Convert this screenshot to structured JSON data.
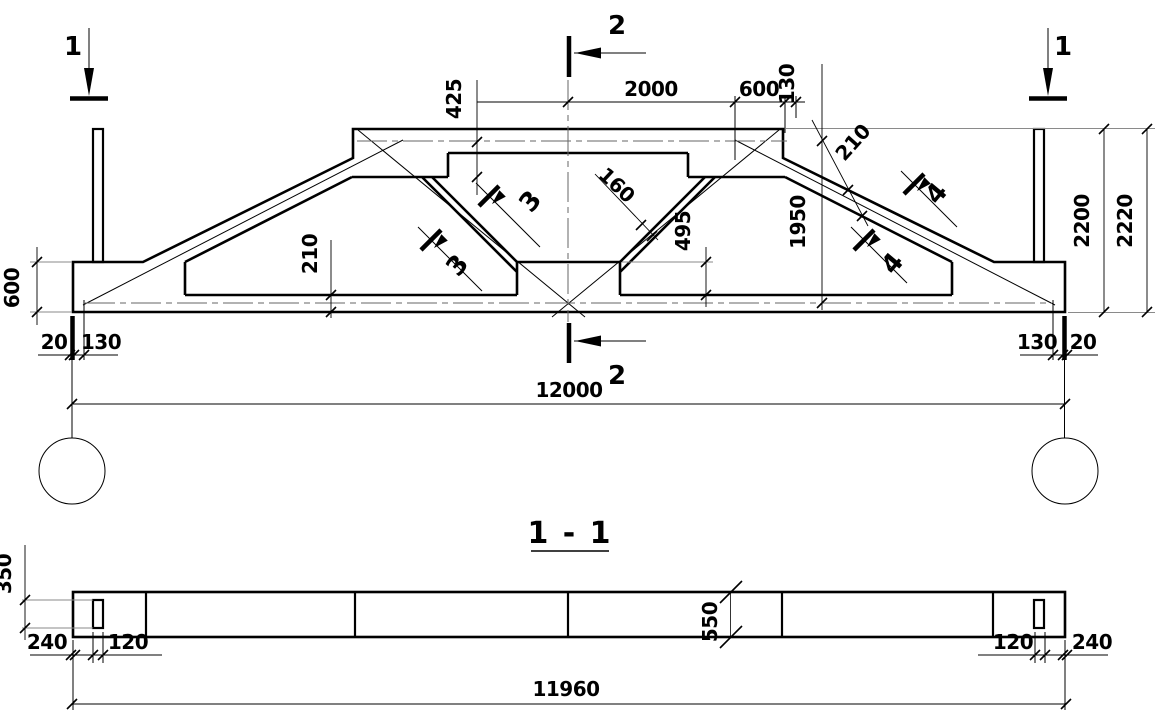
{
  "colors": {
    "line": "#000000",
    "aux": "#8a8a8a",
    "background": "#ffffff"
  },
  "elevation": {
    "markers": {
      "m1": "1",
      "m2": "2",
      "m3": "3",
      "m4": "4"
    },
    "dims": {
      "top_panel": "2000",
      "top_end": "600",
      "top_edge": "130",
      "chord_axis_offset": "425",
      "inner_height": "1950",
      "height": "2200",
      "overall_height": "2220",
      "end_block_height": "600",
      "bottom_chord_thk": "210",
      "top_chord_thk": "210",
      "strut_thk": "160",
      "mid_height": "495",
      "gap": "20",
      "bearing": "130",
      "span": "12000"
    }
  },
  "section": {
    "title": "1 - 1",
    "dims": {
      "slot_height": "350",
      "end_offset": "240",
      "slot_width": "120",
      "beam_height": "550",
      "length": "11960"
    }
  }
}
